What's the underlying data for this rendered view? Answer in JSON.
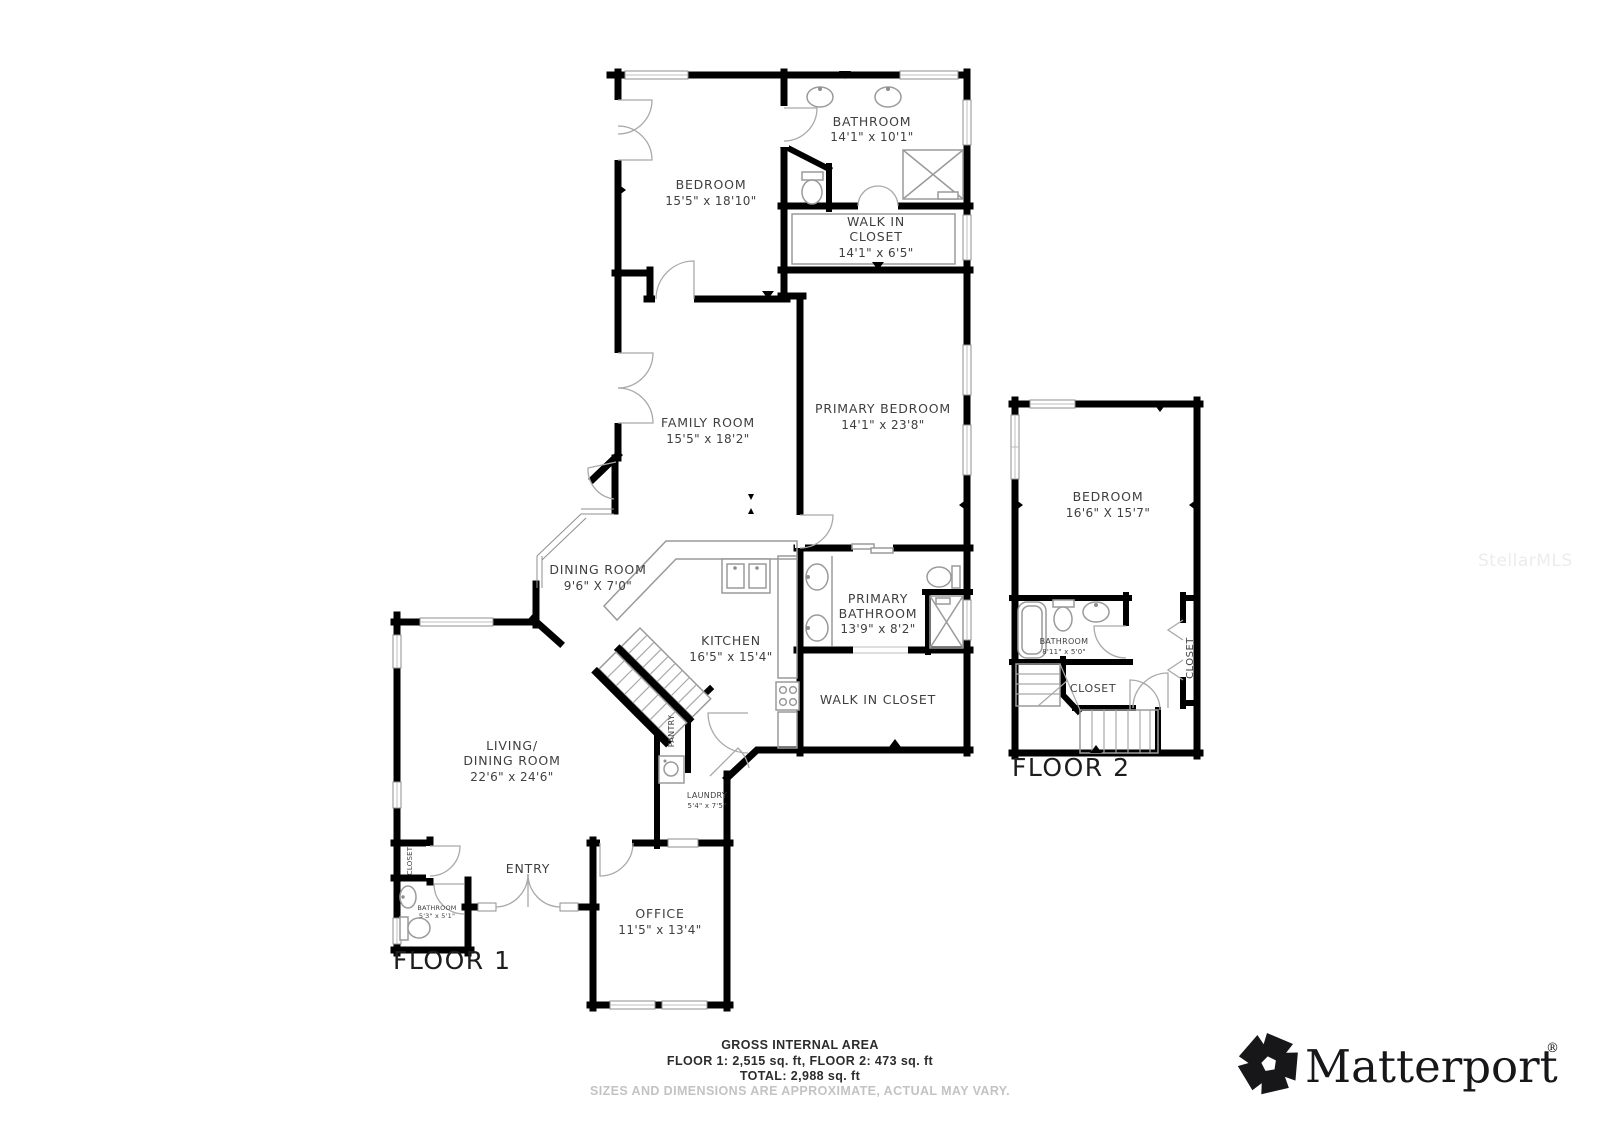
{
  "floor1": {
    "label": "FLOOR 1",
    "rooms": {
      "bedroom": {
        "name": "BEDROOM",
        "dims": "15'5\" x 18'10\""
      },
      "bathroom": {
        "name": "BATHROOM",
        "dims": "14'1\" x 10'1\""
      },
      "walk_in_closet": {
        "line1": "WALK IN",
        "line2": "CLOSET",
        "dims": "14'1\" x 6'5\""
      },
      "family_room": {
        "name": "FAMILY ROOM",
        "dims": "15'5\" x 18'2\""
      },
      "primary_bedroom": {
        "name": "PRIMARY BEDROOM",
        "dims": "14'1\" x 23'8\""
      },
      "dining_room": {
        "name": "DINING ROOM",
        "dims": "9'6\" X 7'0\""
      },
      "kitchen": {
        "name": "KITCHEN",
        "dims": "16'5\" x 15'4\""
      },
      "primary_bathroom": {
        "line1": "PRIMARY",
        "line2": "BATHROOM",
        "dims": "13'9\" x 8'2\""
      },
      "walk_in_closet_2": {
        "name": "WALK IN CLOSET"
      },
      "living_dining": {
        "line1": "LIVING/",
        "line2": "DINING ROOM",
        "dims": "22'6\" x 24'6\""
      },
      "pantry": {
        "name": "PANTRY"
      },
      "laundry": {
        "name": "LAUNDRY",
        "dims": "5'4\" x 7'5\""
      },
      "entry": {
        "name": "ENTRY"
      },
      "office": {
        "name": "OFFICE",
        "dims": "11'5\" x 13'4\""
      },
      "bathroom_small": {
        "name": "BATHROOM",
        "dims": "5'3\" x 5'1\""
      },
      "closet": {
        "name": "CLOSET"
      }
    }
  },
  "floor2": {
    "label": "FLOOR 2",
    "rooms": {
      "bedroom": {
        "name": "BEDROOM",
        "dims": "16'6\" X 15'7\""
      },
      "bathroom": {
        "name": "BATHROOM",
        "dims": "8'11\" x 5'0\""
      },
      "closet": {
        "name": "CLOSET"
      },
      "closet_side": {
        "name": "CLOSET"
      }
    }
  },
  "footer": {
    "title": "GROSS INTERNAL AREA",
    "areas": "FLOOR 1: 2,515 sq. ft, FLOOR 2: 473 sq. ft",
    "total": "TOTAL: 2,988 sq. ft",
    "disclaimer": "SIZES AND DIMENSIONS ARE APPROXIMATE, ACTUAL MAY VARY."
  },
  "branding": {
    "logo": "Matterport",
    "registered": "®",
    "watermark": "StellarMLS"
  },
  "colors": {
    "wall": "#000000",
    "label": "#3f3f3f",
    "fixture": "#9a9a9a",
    "disclaimer": "#c3c3c3"
  }
}
